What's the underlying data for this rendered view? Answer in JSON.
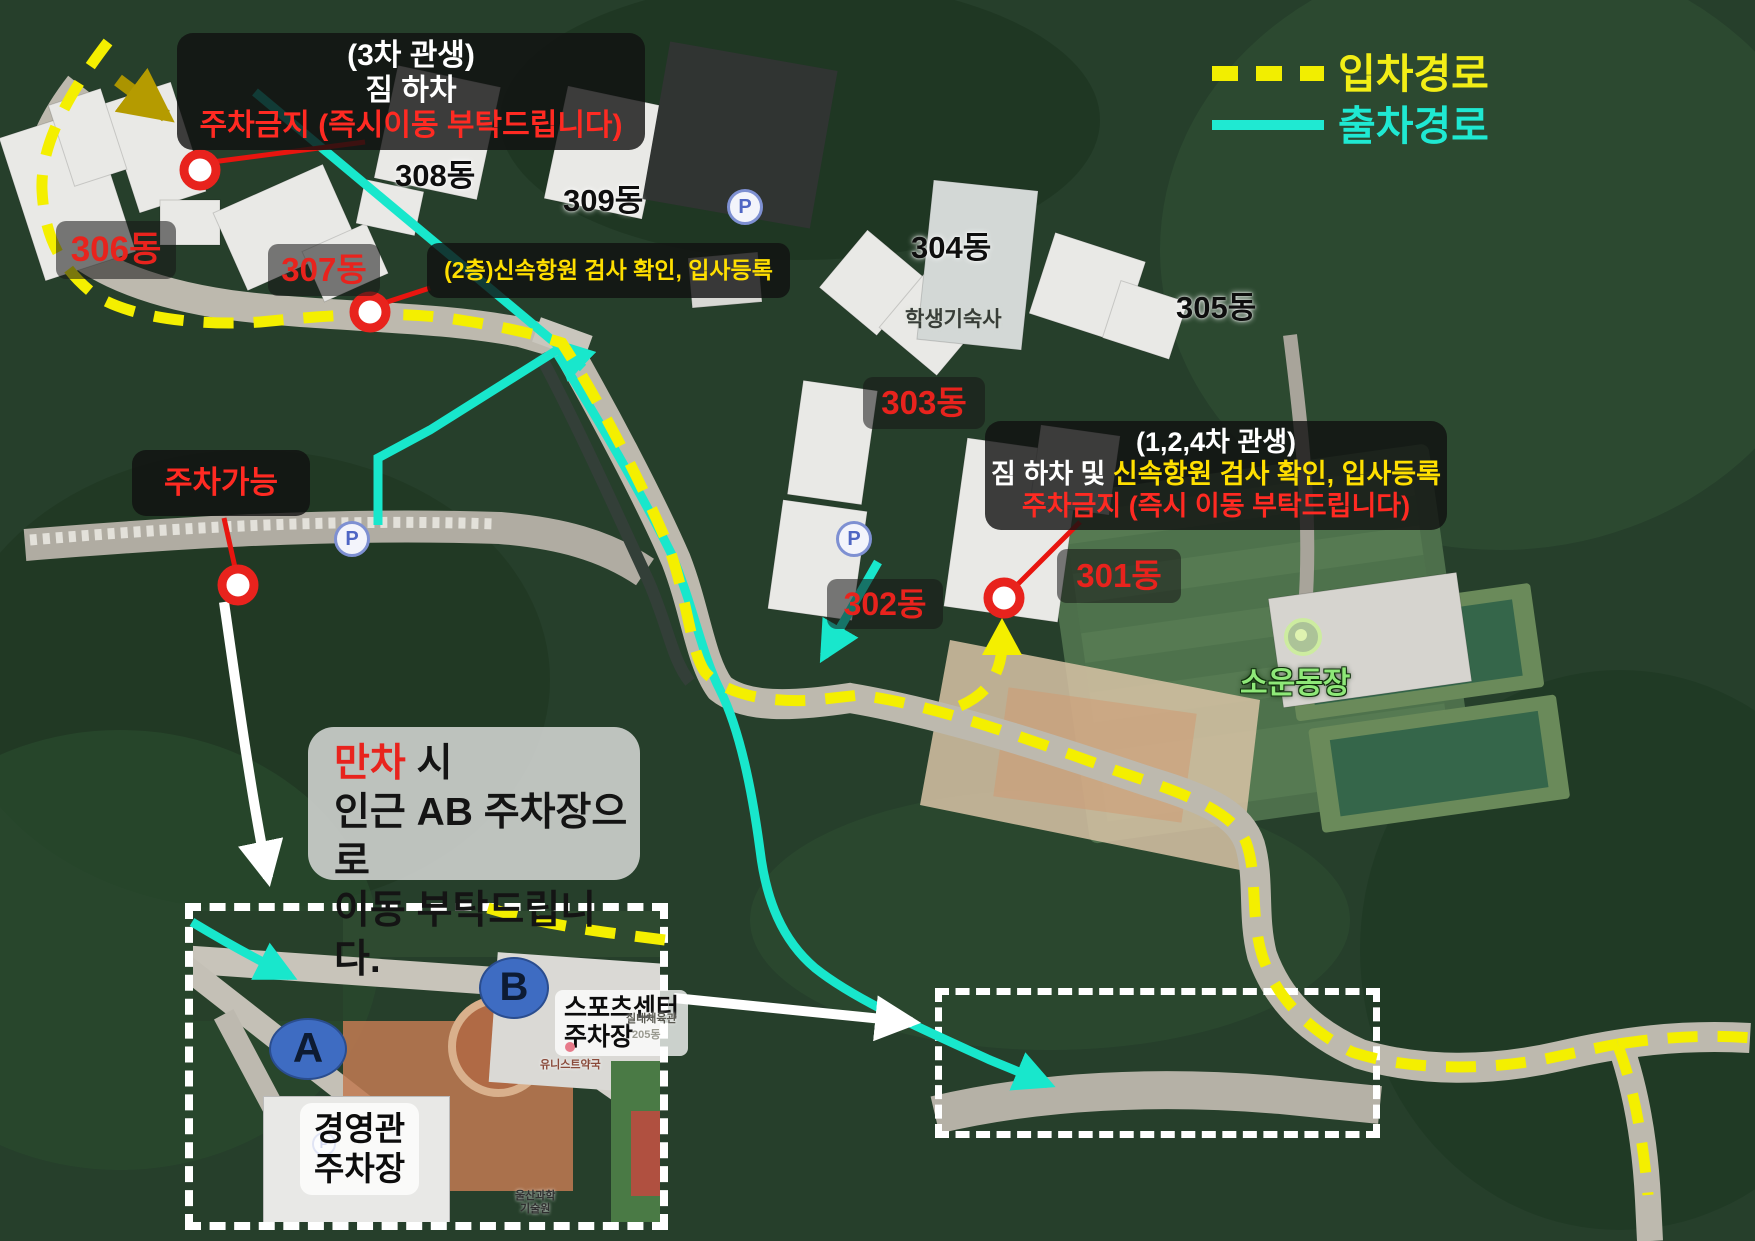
{
  "legend": {
    "entry": "입차경로",
    "exit": "출차경로"
  },
  "annotations": {
    "cha3": {
      "line1": "(3차 관생)",
      "line2": "짐 하차",
      "line3": "주차금지 (즉시이동 부탁드립니다)"
    },
    "floor2": "(2층)신속항원 검사 확인, 입사등록",
    "cha124": {
      "line1": "(1,2,4차 관생)",
      "line2a": "짐 하차 및 ",
      "line2b": "신속항원 검사 확인, 입사등록",
      "line3": "주차금지 (즉시 이동 부탁드립니다)"
    },
    "parking_ok": "주차가능",
    "full_notice": {
      "word": "만차",
      "line1_rest": " 시",
      "line2": "인근 AB 주차장으로",
      "line3": "이동 부탁드립니다."
    }
  },
  "buildings": {
    "b301": "301동",
    "b302": "302동",
    "b303": "303동",
    "b304": "304동",
    "b305": "305동",
    "b306": "306동",
    "b307": "307동",
    "b308": "308동",
    "b309": "309동",
    "dorm_area": "학생기숙사",
    "field": "소운동장"
  },
  "inset": {
    "a": "A",
    "b": "B",
    "sports": [
      "스포츠센터",
      "주차장"
    ],
    "mgmt": [
      "경영관",
      "주차장"
    ],
    "pharmacy": "유니스트약국",
    "gym": "실내체육관",
    "bldg205": "205동",
    "univ": [
      "울산과학",
      "기술원"
    ]
  },
  "icons": {
    "parking": "P"
  },
  "colors": {
    "entry_yellow": "#f4ef00",
    "exit_cyan": "#18e7cc",
    "alert_red": "#ff2a22",
    "note_yellow": "#ffdf00"
  }
}
